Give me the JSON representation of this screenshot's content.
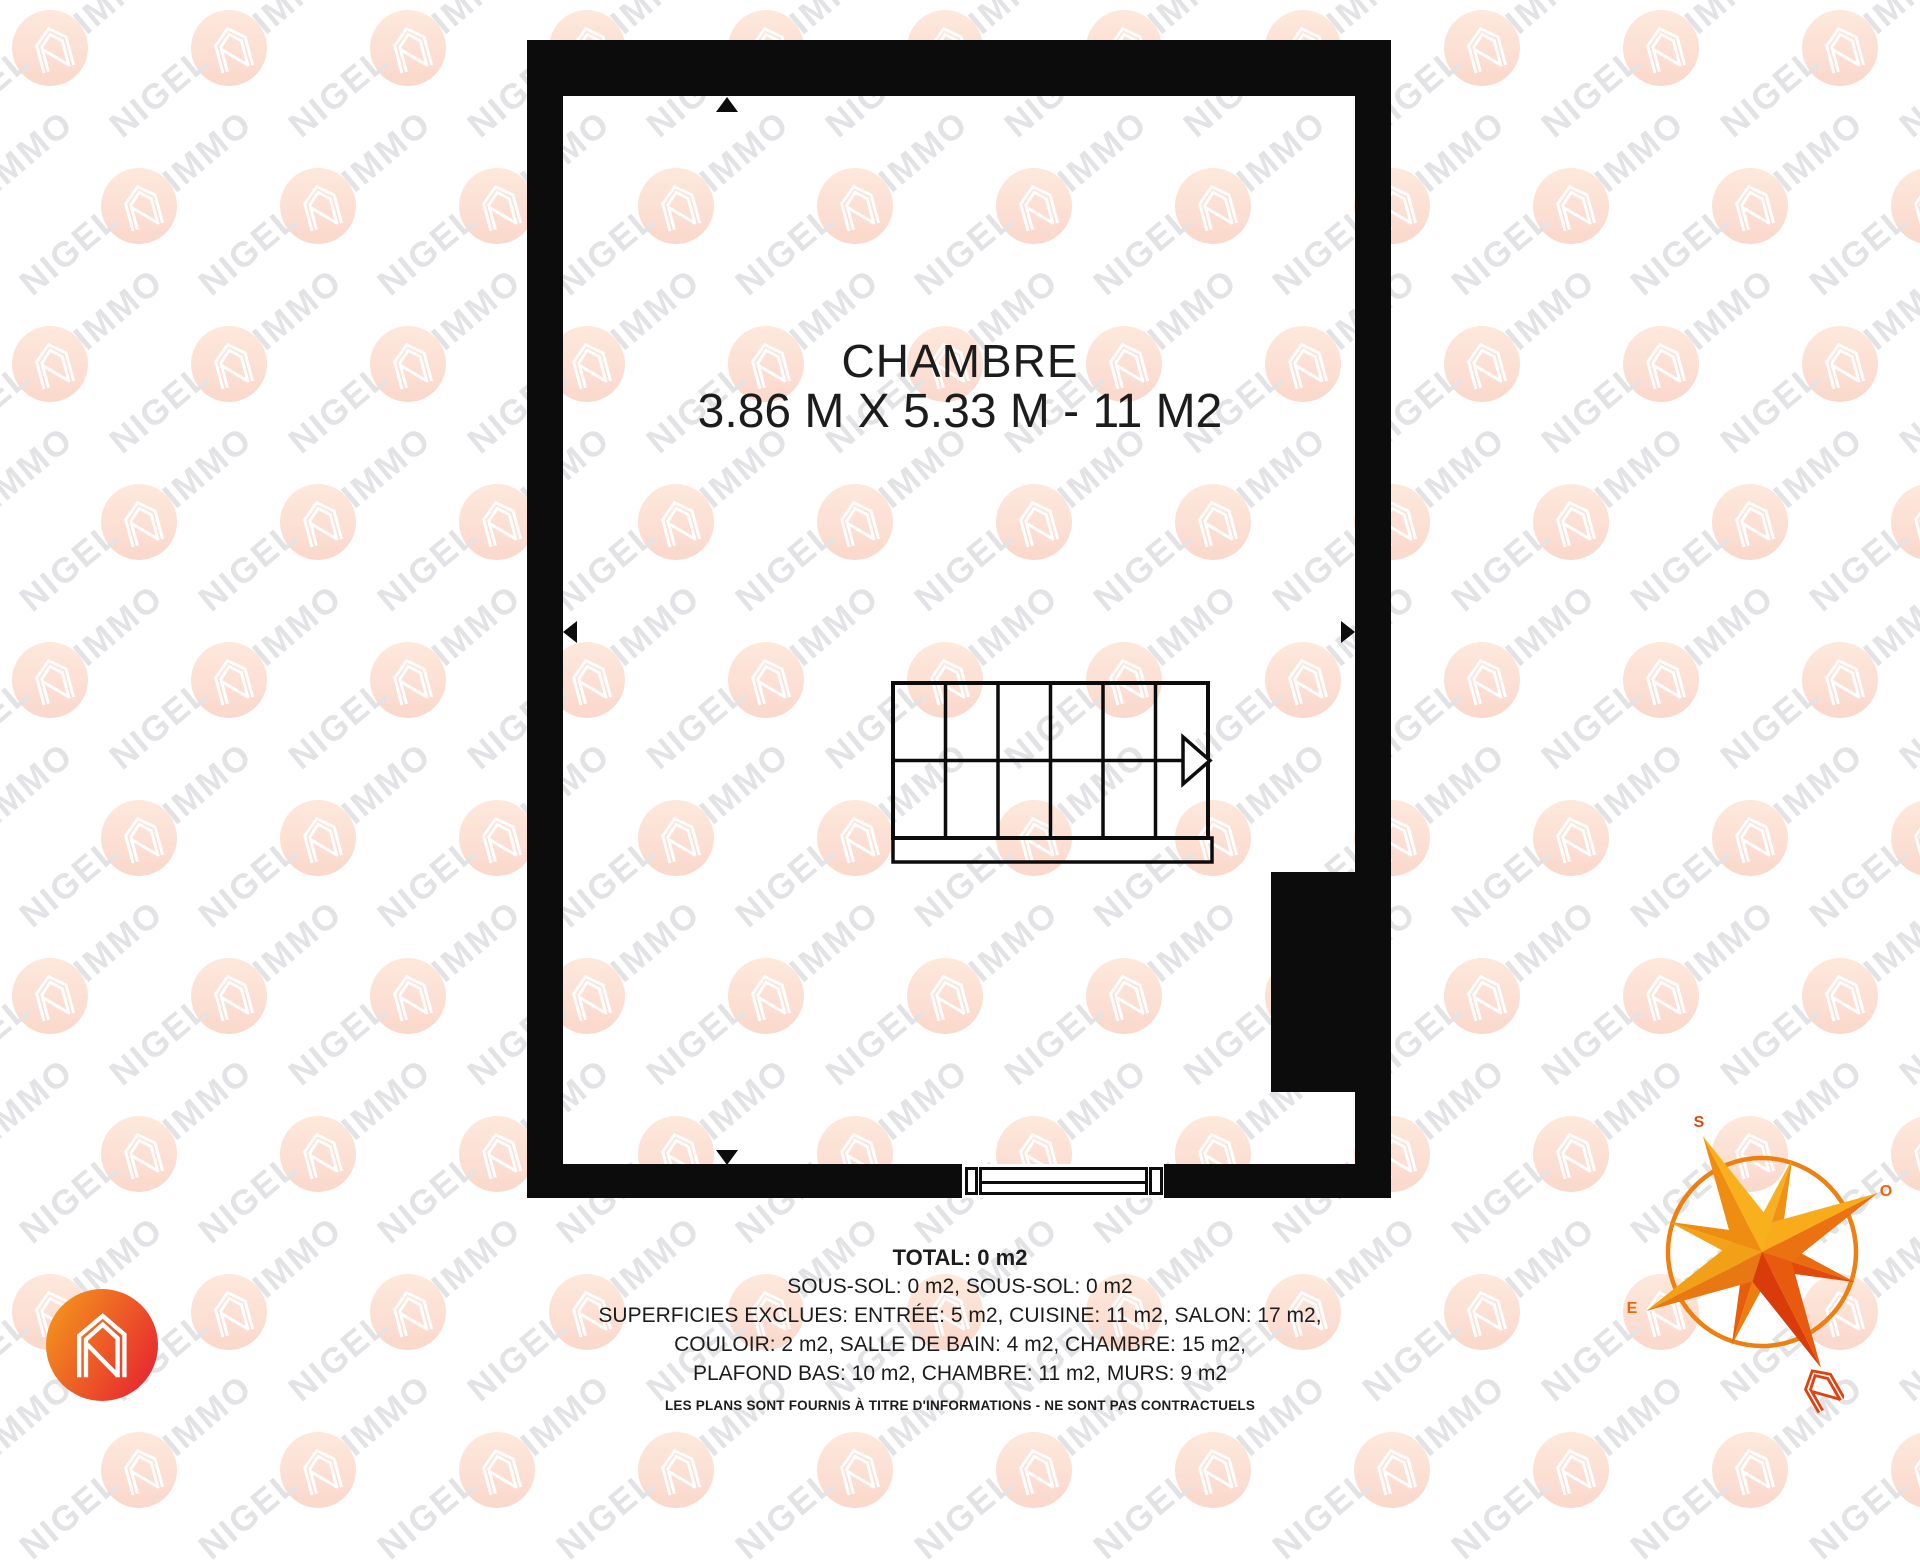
{
  "plan": {
    "room_label": "CHAMBRE",
    "room_dimensions": "3.86 M X 5.33 M - 11 M2"
  },
  "summary": {
    "total": "TOTAL: 0 m2",
    "lines": [
      "SOUS-SOL: 0 m2, SOUS-SOL: 0 m2",
      "SUPERFICIES EXCLUES: ENTRÉE: 5 m2, CUISINE: 11 m2, SALON: 17 m2,",
      "COULOIR: 2 m2, SALLE DE BAIN: 4 m2, CHAMBRE: 15 m2,",
      "PLAFOND BAS: 10 m2, CHAMBRE: 11 m2, MURS: 9 m2"
    ],
    "disclaimer": "LES PLANS SONT FOURNIS À TITRE D'INFORMATIONS - NE SONT PAS CONTRACTUELS"
  },
  "watermark": {
    "word_primary": "NIGEL",
    "word_secondary": "IMMO",
    "circle_color_top": "#fde4d4",
    "circle_color_bottom": "#fbcfc0"
  },
  "brand": {
    "gradient_start": "#f3941d",
    "gradient_end": "#e72530"
  },
  "compass": {
    "label_top": "S",
    "label_right": "O",
    "label_left": "E",
    "ring_color": "#ee8012",
    "accent": "#e2400c",
    "spikes": {
      "s": [
        "#ef8d12",
        "#f8b01d"
      ],
      "o": [
        "#f8ac1b",
        "#ec7211"
      ],
      "n": [
        "#d93c0a",
        "#e85a0e"
      ],
      "e": [
        "#f3a019",
        "#e87812"
      ]
    },
    "diagonals": {
      "ne": [
        "#f6b021",
        "#f09114"
      ],
      "se": [
        "#ea6c10",
        "#e14a0b"
      ],
      "sw": [
        "#ee7d10",
        "#e65d0c"
      ],
      "nw": [
        "#f4a318",
        "#ef8d12"
      ]
    }
  },
  "colors": {
    "wall": "#0c0c0c",
    "text": "#1c1c1c",
    "wm_text": "#e3e3e6",
    "compass_label_top": "#e04a0c",
    "compass_label_side": "#ea670e"
  }
}
